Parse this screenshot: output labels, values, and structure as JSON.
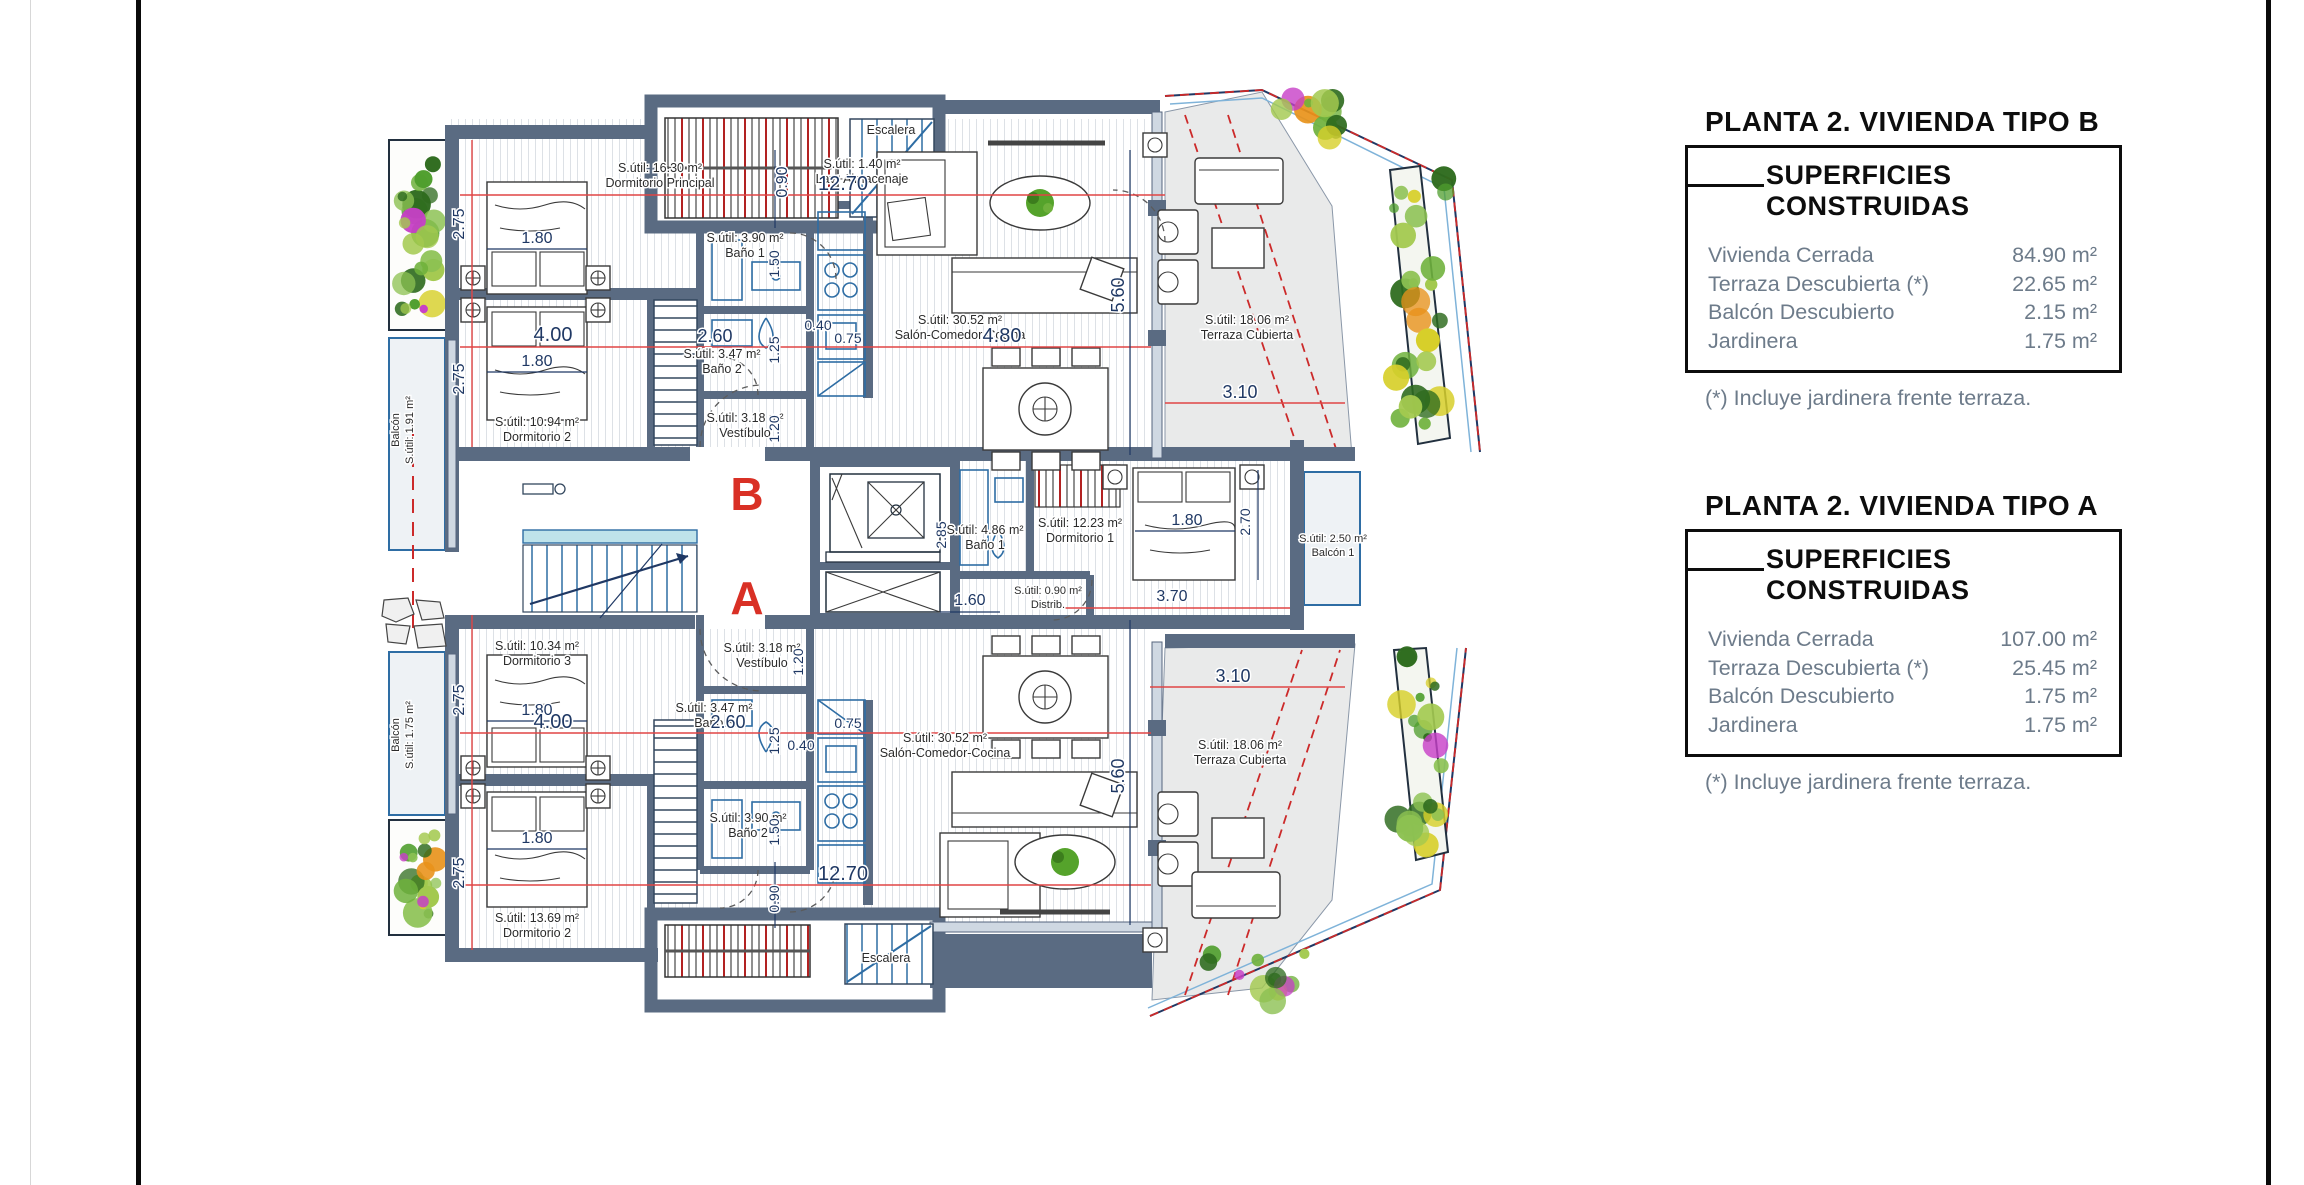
{
  "panels": [
    {
      "title": "PLANTA 2. VIVIENDA TIPO B",
      "header": "SUPERFICIES CONSTRUIDAS",
      "rows": [
        {
          "label": "Vivienda Cerrada",
          "value": "84.90 m²"
        },
        {
          "label": "Terraza Descubierta (*)",
          "value": "22.65 m²"
        },
        {
          "label": "Balcón Descubierto",
          "value": "2.15 m²"
        },
        {
          "label": "Jardinera",
          "value": "1.75 m²"
        }
      ],
      "footnote": "(*) Incluye jardinera frente terraza."
    },
    {
      "title": "PLANTA 2. VIVIENDA TIPO A",
      "header": "SUPERFICIES CONSTRUIDAS",
      "rows": [
        {
          "label": "Vivienda Cerrada",
          "value": "107.00 m²"
        },
        {
          "label": "Terraza Descubierta (*)",
          "value": "25.45 m²"
        },
        {
          "label": "Balcón Descubierto",
          "value": "1.75 m²"
        },
        {
          "label": "Jardinera",
          "value": "1.75 m²"
        }
      ],
      "footnote": "(*) Incluye jardinera frente terraza."
    }
  ],
  "plan": {
    "unit_b": "B",
    "unit_a": "A",
    "labels": {
      "b_dorm_ppal": {
        "l1": "S.útil: 16.30 m²",
        "l2": "Dormitorio Principal"
      },
      "b_lav": {
        "l1": "S.útil: 1.40 m²",
        "l2": "Lav+Almacenaje"
      },
      "b_escalera": "Escalera",
      "b_bano1": {
        "l1": "S.útil: 3.90 m²",
        "l2": "Baño 1"
      },
      "b_bano2": {
        "l1": "S.útil: 3.47 m²",
        "l2": "Baño 2"
      },
      "b_dorm2": {
        "l1": "S.útil: 10.94 m²",
        "l2": "Dormitorio 2"
      },
      "b_vestibulo": {
        "l1": "S.útil: 3.18 m²",
        "l2": "Vestíbulo"
      },
      "b_salon": {
        "l1": "S.útil: 30.52 m²",
        "l2": "Salón-Comedor-Cocina"
      },
      "b_terraza": {
        "l1": "S.útil: 18.06 m²",
        "l2": "Terraza Cubierta"
      },
      "b_balcon": {
        "l1": "Balcón",
        "l2": "S.útil: 1.91 m²"
      },
      "a_dorm3": {
        "l1": "S.útil: 10.34 m²",
        "l2": "Dormitorio 3"
      },
      "a_vestibulo": {
        "l1": "S.útil: 3.18 m²",
        "l2": "Vestíbulo"
      },
      "a_bano3": {
        "l1": "S.útil: 3.47 m²",
        "l2": "Baño 3"
      },
      "a_bano2": {
        "l1": "S.útil: 3.90 m²",
        "l2": "Baño 2"
      },
      "a_dorm2": {
        "l1": "S.útil: 13.69 m²",
        "l2": "Dormitorio 2"
      },
      "a_salon": {
        "l1": "S.útil: 30.52 m²",
        "l2": "Salón-Comedor-Cocina"
      },
      "a_terraza": {
        "l1": "S.útil: 18.06 m²",
        "l2": "Terraza Cubierta"
      },
      "a_bano1": {
        "l1": "S.útil: 4.86 m²",
        "l2": "Baño 1"
      },
      "a_dorm1": {
        "l1": "S.útil: 12.23 m²",
        "l2": "Dormitorio 1"
      },
      "a_distrib": {
        "l1": "S.útil: 0.90 m²",
        "l2": "Distrib."
      },
      "a_balcon1": {
        "l1": "S.útil: 2.50 m²",
        "l2": "Balcón 1"
      },
      "a_balcon": {
        "l1": "Balcón",
        "l2": "S.útil: 1.75 m²"
      },
      "a_escalera": "Escalera"
    },
    "dims": {
      "b_1270": "12.70",
      "b_090": "0.90",
      "b_275_top": "2.75",
      "b_180_top": "1.80",
      "b_150": "1.50",
      "b_040": "0.40",
      "b_260": "2.60",
      "b_125": "1.25",
      "b_075": "0.75",
      "b_400": "4.00",
      "b_180_bot": "1.80",
      "b_275_bot": "2.75",
      "b_120": "1.20",
      "b_480": "4.80",
      "b_560": "5.60",
      "b_310": "3.10",
      "core_285": "2.85",
      "core_160": "1.60",
      "a_370": "3.70",
      "a_180_d1": "1.80",
      "a_270": "2.70",
      "a_120": "1.20",
      "a_275_top": "2.75",
      "a_180_top": "1.80",
      "a_400": "4.00",
      "a_260": "2.60",
      "a_125": "1.25",
      "a_040": "0.40",
      "a_075": "0.75",
      "a_150": "1.50",
      "a_180_bot": "1.80",
      "a_275_bot": "2.75",
      "a_1270": "12.70",
      "a_090": "0.90",
      "a_560": "5.60",
      "a_310": "3.10"
    }
  },
  "colors": {
    "wall": "#5a6b82",
    "dim_red": "#e04545",
    "navy": "#1f3864",
    "unit_letter": "#d93025",
    "fixture": "#2e6da4",
    "terrace": "#e9eaea",
    "balcony": "#eef2f5"
  }
}
